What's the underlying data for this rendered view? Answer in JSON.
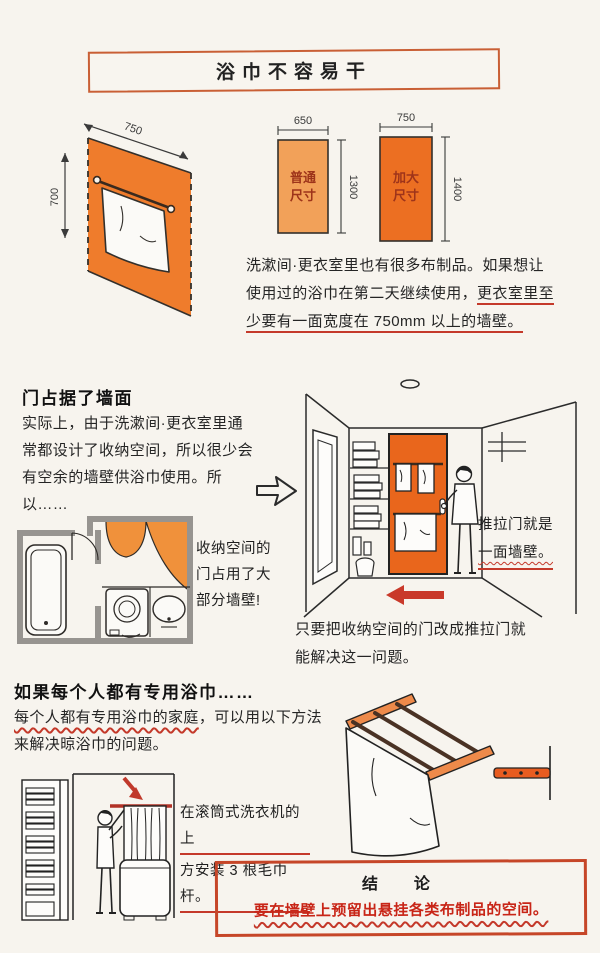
{
  "title": "浴巾不容易干",
  "colors": {
    "orange": "#ec6f22",
    "orange_light": "#f2a159",
    "orange_plan": "#f0913b",
    "red_mark": "#c4392a",
    "red_text": "#c82517",
    "box_border": "#c95f35"
  },
  "intro": {
    "wall": {
      "width": "750",
      "height": "700"
    },
    "towels": [
      {
        "width": "650",
        "height": "1300",
        "label_line1": "普通",
        "label_line2": "尺寸"
      },
      {
        "width": "750",
        "height": "1400",
        "label_line1": "加大",
        "label_line2": "尺寸"
      }
    ],
    "paragraph": {
      "line1": "洗漱间·更衣室里也有很多布制品。如果想让",
      "line2_plain": "使用过的浴巾在第二天继续使用，",
      "line2_marked": "更衣室里至",
      "line3_marked": "少要有一面宽度在 750mm 以上的墙壁。"
    }
  },
  "section_door": {
    "heading": "门占据了墙面",
    "body_lines": [
      "实际上，由于洗漱间·更衣室里通",
      "常都设计了收纳空间，所以很少会",
      "有空余的墙壁供浴巾使用。所",
      "以……"
    ],
    "plan_caption_lines": [
      "收纳空间的",
      "门占用了大",
      "部分墙壁!"
    ],
    "annotation_line1": "推拉门就是",
    "annotation_line2": "一面墙壁。",
    "result_lines": [
      "只要把收纳空间的门改成推拉门就",
      "能解决这一问题。"
    ]
  },
  "section_personal": {
    "heading": "如果每个人都有专用浴巾……",
    "line1_marked": "每个人都有专用浴巾的家庭",
    "line1_plain": "，可以用以下方法",
    "line2": "来解决晾浴巾的问题。",
    "washer_caption_lines": [
      "在滚筒式洗衣机的上",
      "方安装 3 根毛巾杆。"
    ]
  },
  "conclusion": {
    "heading": "结　论",
    "text": "要在墙壁上预留出悬挂各类布制品的空间。"
  }
}
